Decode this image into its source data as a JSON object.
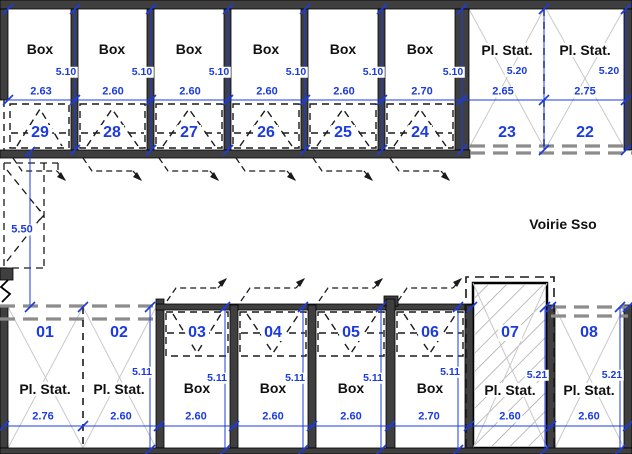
{
  "plan": {
    "road_label": "Voirie Sso",
    "entrance_depth_dim": "5.50",
    "top_row": [
      {
        "label": "Box",
        "number": "29",
        "width": "2.63",
        "depth": "5.10"
      },
      {
        "label": "Box",
        "number": "28",
        "width": "2.60",
        "depth": "5.10"
      },
      {
        "label": "Box",
        "number": "27",
        "width": "2.60",
        "depth": "5.10"
      },
      {
        "label": "Box",
        "number": "26",
        "width": "2.60",
        "depth": "5.10"
      },
      {
        "label": "Box",
        "number": "25",
        "width": "2.60",
        "depth": "5.10"
      },
      {
        "label": "Box",
        "number": "24",
        "width": "2.70",
        "depth": "5.10"
      },
      {
        "label": "Pl. Stat.",
        "number": "23",
        "width": "2.65",
        "depth": "5.20"
      },
      {
        "label": "Pl. Stat.",
        "number": "22",
        "width": "2.75",
        "depth": "5.20"
      }
    ],
    "bottom_row": [
      {
        "label": "Pl. Stat.",
        "number": "01",
        "width": "2.76"
      },
      {
        "label": "Pl. Stat.",
        "number": "02",
        "width": "2.60",
        "depth": "5.11"
      },
      {
        "label": "Box",
        "number": "03",
        "width": "2.60",
        "depth": "5.11"
      },
      {
        "label": "Box",
        "number": "04",
        "width": "2.60",
        "depth": "5.11"
      },
      {
        "label": "Box",
        "number": "05",
        "width": "2.60",
        "depth": "5.11"
      },
      {
        "label": "Box",
        "number": "06",
        "width": "2.70",
        "depth": "5.11"
      },
      {
        "label": "Pl. Stat.",
        "number": "07",
        "width": "2.60",
        "depth": "5.21"
      },
      {
        "label": "Pl. Stat.",
        "number": "08",
        "width": "2.60",
        "depth": "5.21"
      }
    ],
    "colors": {
      "dimension_blue": "#1b3be0",
      "wall_dark": "#3f3f3f",
      "cross_gray": "#c9c9c9",
      "dashed_gray": "#8c8c8c"
    }
  }
}
